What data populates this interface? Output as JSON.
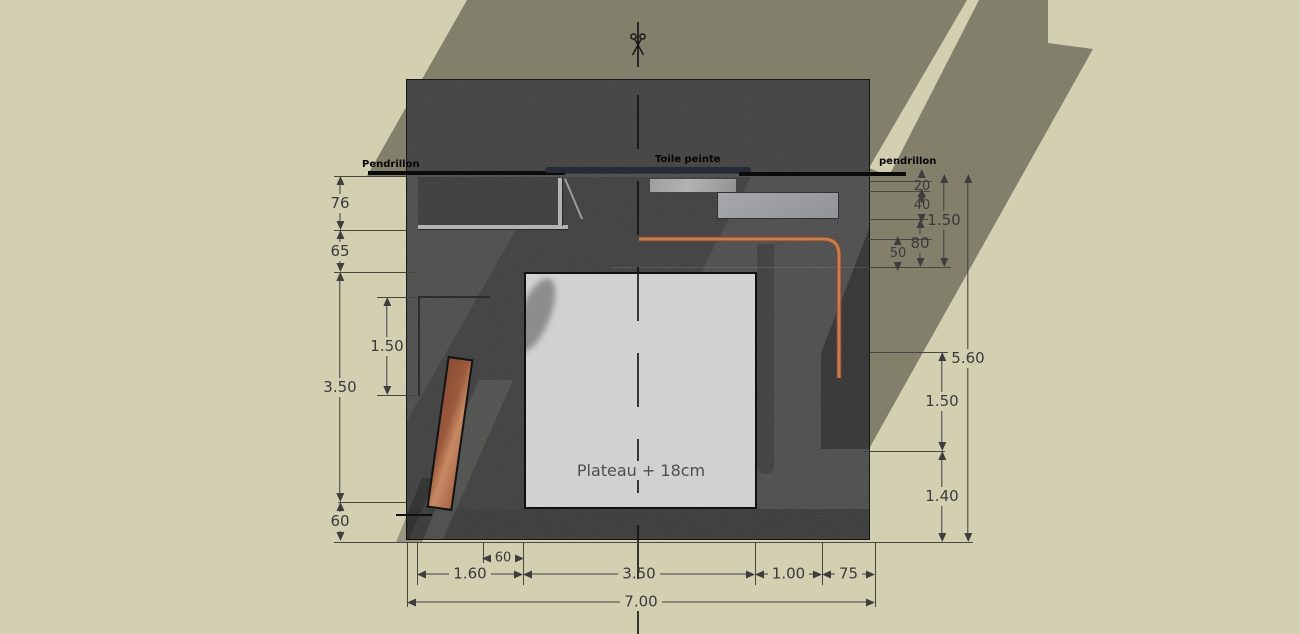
{
  "labels": {
    "pendrillon_left": "Pendrillon",
    "toile_peinte": "Toile peinte",
    "pendrillon_right": "pendrillon",
    "plateau": "Plateau + 18cm"
  },
  "colors": {
    "background_khaki": "#d3d0b2",
    "shadow_olive": "#82806b",
    "stage_gray": "#4a4a4a",
    "plateau_gray": "#d1d1d1",
    "pipe_copper": "#c67d53",
    "plank_wood": "#a9623f",
    "toile_bar_navy": "#262b37",
    "dimension_ink": "#3e3e3e"
  },
  "dimensions": {
    "vertical": [
      {
        "value": "76",
        "x": 340,
        "y1": 176,
        "y2": 230
      },
      {
        "value": "65",
        "x": 340,
        "y1": 230,
        "y2": 272
      },
      {
        "value": "3.50",
        "x": 340,
        "y1": 272,
        "y2": 502
      },
      {
        "value": "60",
        "x": 340,
        "y1": 502,
        "y2": 541
      },
      {
        "value": "1.50",
        "x": 387,
        "y1": 297,
        "y2": 395
      },
      {
        "value": "20",
        "x": 922,
        "y1": 181,
        "y2": 191,
        "small": true
      },
      {
        "value": "40",
        "x": 922,
        "y1": 191,
        "y2": 219,
        "small": true
      },
      {
        "value": "80",
        "x": 920,
        "y1": 219,
        "y2": 267
      },
      {
        "value": "50",
        "x": 898,
        "y1": 239,
        "y2": 267,
        "small": true
      },
      {
        "value": "1.50",
        "x": 944,
        "y1": 174,
        "y2": 267
      },
      {
        "value": "5.60",
        "x": 968,
        "y1": 174,
        "y2": 542
      },
      {
        "value": "1.50",
        "x": 942,
        "y1": 352,
        "y2": 451
      },
      {
        "value": "1.40",
        "x": 942,
        "y1": 451,
        "y2": 542
      }
    ],
    "horizontal": [
      {
        "value": "60",
        "y": 558,
        "x1": 483,
        "x2": 523,
        "small": true
      },
      {
        "value": "1.60",
        "y": 574,
        "x1": 417,
        "x2": 523
      },
      {
        "value": "3.50",
        "y": 574,
        "x1": 523,
        "x2": 755
      },
      {
        "value": "1.00",
        "y": 574,
        "x1": 755,
        "x2": 822
      },
      {
        "value": "75",
        "y": 574,
        "x1": 822,
        "x2": 875
      },
      {
        "value": "7.00",
        "y": 602,
        "x1": 407,
        "x2": 875
      }
    ],
    "extension_lines": [
      {
        "x1": 334,
        "y1": 176,
        "x2": 408,
        "y2": 176
      },
      {
        "x1": 334,
        "y1": 230,
        "x2": 408,
        "y2": 230
      },
      {
        "x1": 334,
        "y1": 272,
        "x2": 415,
        "y2": 272
      },
      {
        "x1": 377,
        "y1": 297,
        "x2": 417,
        "y2": 297
      },
      {
        "x1": 377,
        "y1": 395,
        "x2": 415,
        "y2": 395
      },
      {
        "x1": 338,
        "y1": 502,
        "x2": 406,
        "y2": 502
      },
      {
        "x1": 334,
        "y1": 542,
        "x2": 973,
        "y2": 542
      },
      {
        "x1": 868,
        "y1": 181,
        "x2": 932,
        "y2": 181
      },
      {
        "x1": 868,
        "y1": 191,
        "x2": 930,
        "y2": 191
      },
      {
        "x1": 868,
        "y1": 219,
        "x2": 928,
        "y2": 219
      },
      {
        "x1": 868,
        "y1": 239,
        "x2": 932,
        "y2": 239
      },
      {
        "x1": 868,
        "y1": 267,
        "x2": 951,
        "y2": 267
      },
      {
        "x1": 870,
        "y1": 352,
        "x2": 948,
        "y2": 352
      },
      {
        "x1": 863,
        "y1": 451,
        "x2": 945,
        "y2": 451
      },
      {
        "x1": 407,
        "y1": 542,
        "x2": 407,
        "y2": 607
      },
      {
        "x1": 417,
        "y1": 542,
        "x2": 417,
        "y2": 585
      },
      {
        "x1": 483,
        "y1": 542,
        "x2": 483,
        "y2": 563
      },
      {
        "x1": 523,
        "y1": 542,
        "x2": 523,
        "y2": 585
      },
      {
        "x1": 755,
        "y1": 542,
        "x2": 755,
        "y2": 585
      },
      {
        "x1": 822,
        "y1": 542,
        "x2": 822,
        "y2": 585
      },
      {
        "x1": 875,
        "y1": 542,
        "x2": 875,
        "y2": 607
      }
    ]
  }
}
